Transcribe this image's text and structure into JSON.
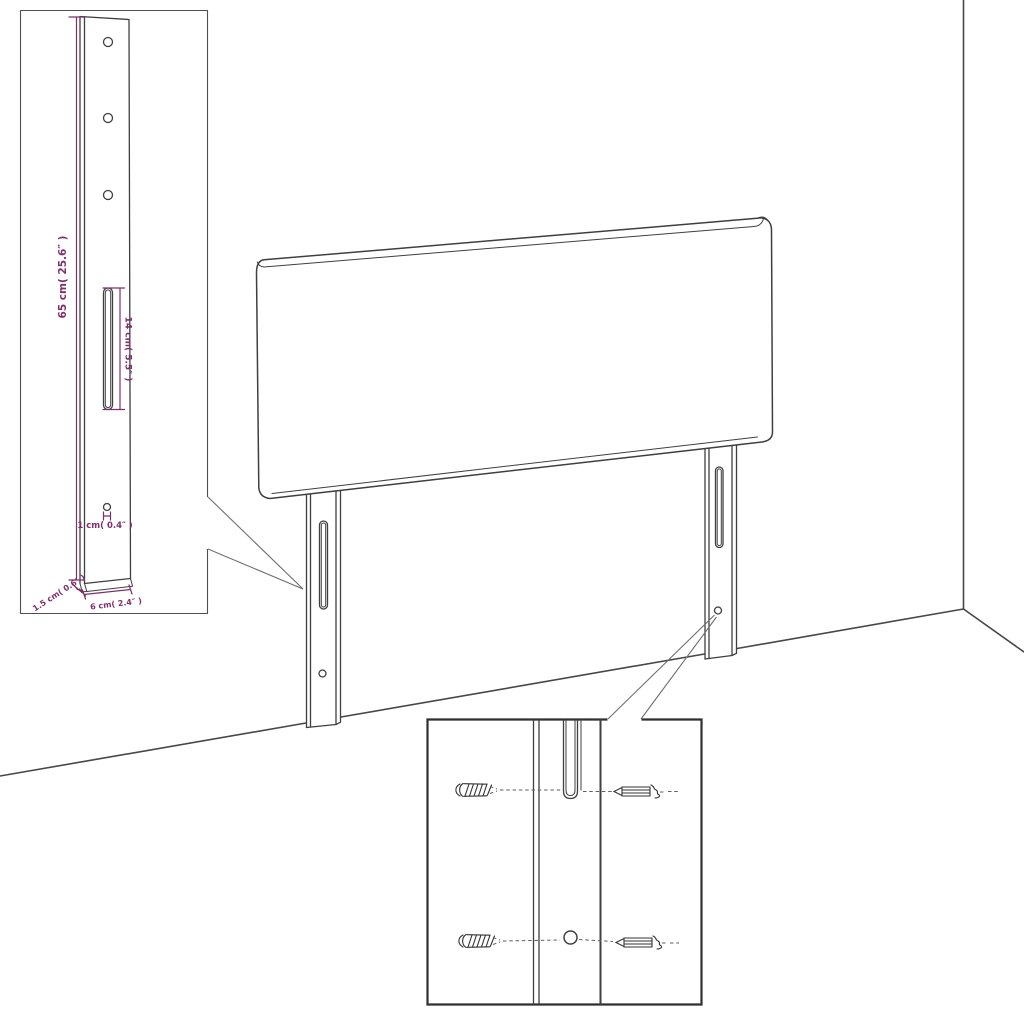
{
  "diagram": {
    "title": "headboard-assembly-diagram",
    "colors": {
      "background": "#ffffff",
      "line": "#3f3f3f",
      "dimension": "#7d2f6c",
      "leader": "#6f6f6f"
    },
    "insets": {
      "leg_detail": {
        "dimensions": {
          "height": "65 cm( 25.6″ )",
          "slot": "14 cm( 5.5″ )",
          "hole": "1 cm( 0.4″ )",
          "depth": "1.5 cm( 0.6″ )",
          "width": "6 cm( 2.4″ )"
        }
      },
      "mounting_detail": {
        "parts": [
          "wood-screw",
          "machine-screw",
          "slot",
          "hole"
        ]
      }
    }
  }
}
